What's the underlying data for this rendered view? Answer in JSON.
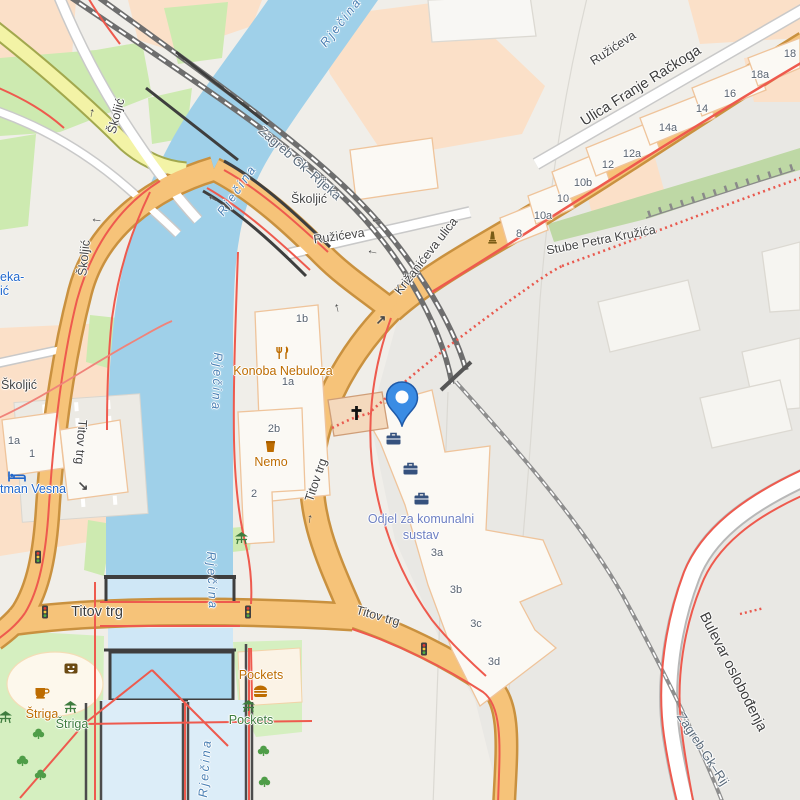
{
  "colors": {
    "water": "#9fd0e9",
    "water_channel": "#dcedf8",
    "road_orange": "#f6c379",
    "road_orange_casing": "#c9913f",
    "road_yellow": "#f3f3a6",
    "residential_peach": "#fbe0c8",
    "park_green": "#cdeab0",
    "building_fill": "#fbf9f4",
    "building_outline": "#efc49b",
    "route_red": "#ee5a4e",
    "railway_gray": "#6e6e6e",
    "marker_blue": "#3a8ce4",
    "poi_orange": "#bd6c00",
    "poi_green": "#3f7d3f",
    "poi_blue": "#2268cc",
    "office_label": "#6e80c2",
    "water_label": "#4b80b4",
    "street_label": "#454545"
  },
  "marker": {
    "name": "location-pin",
    "x": 402,
    "y": 427
  },
  "labels": [
    {
      "name": "street-label",
      "type": "street",
      "text": "Školjić",
      "x": 19,
      "y": 385,
      "r": 0
    },
    {
      "name": "street-label",
      "type": "street",
      "text": "Školjić",
      "x": 116,
      "y": 116,
      "r": -75
    },
    {
      "name": "street-label",
      "type": "street",
      "text": "Školjić",
      "x": 84,
      "y": 258,
      "r": -84
    },
    {
      "name": "street-label",
      "type": "street",
      "text": "Školjić",
      "x": 309,
      "y": 199,
      "r": 0
    },
    {
      "name": "street-label",
      "type": "street",
      "text": "Ružićeva",
      "x": 339,
      "y": 236,
      "r": -8
    },
    {
      "name": "street-label",
      "type": "street",
      "text": "Ružićeva",
      "x": 613,
      "y": 48,
      "r": -33
    },
    {
      "name": "street-label",
      "type": "street-lg",
      "text": "Ulica Franje Račkoga",
      "x": 641,
      "y": 86,
      "r": -32
    },
    {
      "name": "street-label",
      "type": "street",
      "text": "Križanićeva ulica",
      "x": 426,
      "y": 256,
      "r": -52
    },
    {
      "name": "street-label",
      "type": "street",
      "text": "Stube Petra Kružića",
      "x": 601,
      "y": 240,
      "r": -11
    },
    {
      "name": "street-label",
      "type": "street",
      "text": "Titov trg",
      "x": 81,
      "y": 442,
      "r": 94
    },
    {
      "name": "street-label",
      "type": "street",
      "text": "Titov trg",
      "x": 316,
      "y": 480,
      "r": -71
    },
    {
      "name": "street-label",
      "type": "street-lg",
      "text": "Titov trg",
      "x": 97,
      "y": 612,
      "r": 0
    },
    {
      "name": "street-label",
      "type": "street",
      "text": "Titov trg",
      "x": 378,
      "y": 616,
      "r": 16
    },
    {
      "name": "street-label",
      "type": "street-lg",
      "text": "Bulevar oslobođenja",
      "x": 733,
      "y": 672,
      "r": 63
    },
    {
      "name": "railway-label",
      "type": "rail",
      "text": "Zagreb Gk–Rijeka",
      "x": 300,
      "y": 163,
      "r": 41
    },
    {
      "name": "railway-label",
      "type": "rail",
      "text": "Zagreb Gk–Rij",
      "x": 703,
      "y": 749,
      "r": 57
    },
    {
      "name": "water-label",
      "type": "water",
      "text": "Rječina",
      "x": 341,
      "y": 22,
      "r": -52
    },
    {
      "name": "water-label",
      "type": "water",
      "text": "Rječina",
      "x": 237,
      "y": 190,
      "r": -55
    },
    {
      "name": "water-label",
      "type": "water",
      "text": "Rječina",
      "x": 217,
      "y": 382,
      "r": 92
    },
    {
      "name": "water-label",
      "type": "water",
      "text": "Rječina",
      "x": 212,
      "y": 581,
      "r": 88
    },
    {
      "name": "water-label",
      "type": "water",
      "text": "Rječina",
      "x": 205,
      "y": 768,
      "r": -86
    },
    {
      "name": "poi-label",
      "type": "poi-orange",
      "text": "Konoba Nebuloza",
      "x": 283,
      "y": 371,
      "r": 0
    },
    {
      "name": "poi-label",
      "type": "poi-orange",
      "text": "Nemo",
      "x": 271,
      "y": 462,
      "r": 0
    },
    {
      "name": "poi-label",
      "type": "poi-orange",
      "text": "Štriga",
      "x": 42,
      "y": 714,
      "r": 0
    },
    {
      "name": "poi-label",
      "type": "poi-orange",
      "text": "Pockets",
      "x": 261,
      "y": 675,
      "r": 0
    },
    {
      "name": "poi-label",
      "type": "poi-green",
      "text": "Štriga",
      "x": 72,
      "y": 724,
      "r": 0
    },
    {
      "name": "poi-label",
      "type": "poi-green",
      "text": "Pockets",
      "x": 251,
      "y": 720,
      "r": 0
    },
    {
      "name": "poi-label",
      "type": "poi-blue",
      "text": "tman Vesna",
      "x": 0,
      "y": 489,
      "r": 0,
      "align": "left"
    },
    {
      "name": "poi-label",
      "type": "poi-blue",
      "text": "eka-",
      "x": 0,
      "y": 277,
      "r": 0,
      "align": "left"
    },
    {
      "name": "poi-label",
      "type": "poi-blue",
      "text": "ić",
      "x": 0,
      "y": 291,
      "r": 0,
      "align": "left"
    },
    {
      "name": "office-label",
      "type": "office",
      "text": "Odjel za komunalni",
      "x": 421,
      "y": 519,
      "r": 0
    },
    {
      "name": "office-label",
      "type": "office",
      "text": "sustav",
      "x": 421,
      "y": 535,
      "r": 0
    },
    {
      "name": "housenumber",
      "type": "hn",
      "text": "1b",
      "x": 302,
      "y": 319,
      "r": 0
    },
    {
      "name": "housenumber",
      "type": "hn",
      "text": "1a",
      "x": 288,
      "y": 382,
      "r": 0
    },
    {
      "name": "housenumber",
      "type": "hn",
      "text": "2b",
      "x": 274,
      "y": 429,
      "r": 0
    },
    {
      "name": "housenumber",
      "type": "hn",
      "text": "2",
      "x": 254,
      "y": 494,
      "r": 0
    },
    {
      "name": "housenumber",
      "type": "hn",
      "text": "1a",
      "x": 14,
      "y": 441,
      "r": 0
    },
    {
      "name": "housenumber",
      "type": "hn",
      "text": "1",
      "x": 32,
      "y": 454,
      "r": 0
    },
    {
      "name": "housenumber",
      "type": "hn",
      "text": "8",
      "x": 519,
      "y": 234,
      "r": 0
    },
    {
      "name": "housenumber",
      "type": "hn",
      "text": "10a",
      "x": 543,
      "y": 216,
      "r": 0
    },
    {
      "name": "housenumber",
      "type": "hn",
      "text": "10",
      "x": 563,
      "y": 199,
      "r": 0
    },
    {
      "name": "housenumber",
      "type": "hn",
      "text": "10b",
      "x": 583,
      "y": 183,
      "r": 0
    },
    {
      "name": "housenumber",
      "type": "hn",
      "text": "12",
      "x": 608,
      "y": 165,
      "r": 0
    },
    {
      "name": "housenumber",
      "type": "hn",
      "text": "12a",
      "x": 632,
      "y": 154,
      "r": 0
    },
    {
      "name": "housenumber",
      "type": "hn",
      "text": "14a",
      "x": 668,
      "y": 128,
      "r": 0
    },
    {
      "name": "housenumber",
      "type": "hn",
      "text": "14",
      "x": 702,
      "y": 109,
      "r": 0
    },
    {
      "name": "housenumber",
      "type": "hn",
      "text": "16",
      "x": 730,
      "y": 94,
      "r": 0
    },
    {
      "name": "housenumber",
      "type": "hn",
      "text": "18a",
      "x": 760,
      "y": 75,
      "r": 0
    },
    {
      "name": "housenumber",
      "type": "hn",
      "text": "18",
      "x": 790,
      "y": 54,
      "r": 0
    },
    {
      "name": "housenumber",
      "type": "hn",
      "text": "3a",
      "x": 437,
      "y": 553,
      "r": 0
    },
    {
      "name": "housenumber",
      "type": "hn",
      "text": "3b",
      "x": 456,
      "y": 590,
      "r": 0
    },
    {
      "name": "housenumber",
      "type": "hn",
      "text": "3c",
      "x": 476,
      "y": 624,
      "r": 0
    },
    {
      "name": "housenumber",
      "type": "hn",
      "text": "3d",
      "x": 494,
      "y": 662,
      "r": 0
    }
  ],
  "icons": [
    {
      "n": "chapel-cross",
      "x": 356,
      "y": 413
    },
    {
      "n": "briefcase",
      "x": 393,
      "y": 438
    },
    {
      "n": "briefcase",
      "x": 410,
      "y": 468
    },
    {
      "n": "briefcase",
      "x": 421,
      "y": 498
    },
    {
      "n": "restaurant",
      "x": 283,
      "y": 353
    },
    {
      "n": "bar",
      "x": 270,
      "y": 446
    },
    {
      "n": "cafe",
      "x": 42,
      "y": 692
    },
    {
      "n": "fast-food",
      "x": 260,
      "y": 690
    },
    {
      "n": "bed",
      "x": 17,
      "y": 474
    },
    {
      "n": "picnic",
      "x": 70,
      "y": 707
    },
    {
      "n": "picnic",
      "x": 5,
      "y": 717
    },
    {
      "n": "picnic",
      "x": 248,
      "y": 706
    },
    {
      "n": "picnic",
      "x": 241,
      "y": 538
    },
    {
      "n": "theatre",
      "x": 71,
      "y": 666
    },
    {
      "n": "monument",
      "x": 492,
      "y": 237
    },
    {
      "n": "traffic-light",
      "x": 38,
      "y": 557
    },
    {
      "n": "traffic-light",
      "x": 45,
      "y": 612
    },
    {
      "n": "traffic-light",
      "x": 248,
      "y": 612
    },
    {
      "n": "traffic-light",
      "x": 424,
      "y": 649
    },
    {
      "n": "tree",
      "x": 38,
      "y": 733
    },
    {
      "n": "tree",
      "x": 22,
      "y": 760
    },
    {
      "n": "tree",
      "x": 40,
      "y": 774
    },
    {
      "n": "tree",
      "x": 263,
      "y": 750
    },
    {
      "n": "tree",
      "x": 264,
      "y": 781
    }
  ],
  "oneway_arrows": [
    {
      "g": "↑",
      "x": 92,
      "y": 112,
      "r": 12
    },
    {
      "g": "←",
      "x": 97,
      "y": 218,
      "r": 8
    },
    {
      "g": "←",
      "x": 214,
      "y": 197,
      "r": 28
    },
    {
      "g": "←",
      "x": 376,
      "y": 218,
      "r": -10
    },
    {
      "g": "←",
      "x": 373,
      "y": 250,
      "r": 12
    },
    {
      "g": "↑",
      "x": 337,
      "y": 307,
      "r": -14
    },
    {
      "g": "↗",
      "x": 381,
      "y": 320,
      "r": 0
    },
    {
      "g": "↑",
      "x": 310,
      "y": 518,
      "r": 8
    },
    {
      "g": "↘",
      "x": 83,
      "y": 486,
      "r": 0
    }
  ]
}
